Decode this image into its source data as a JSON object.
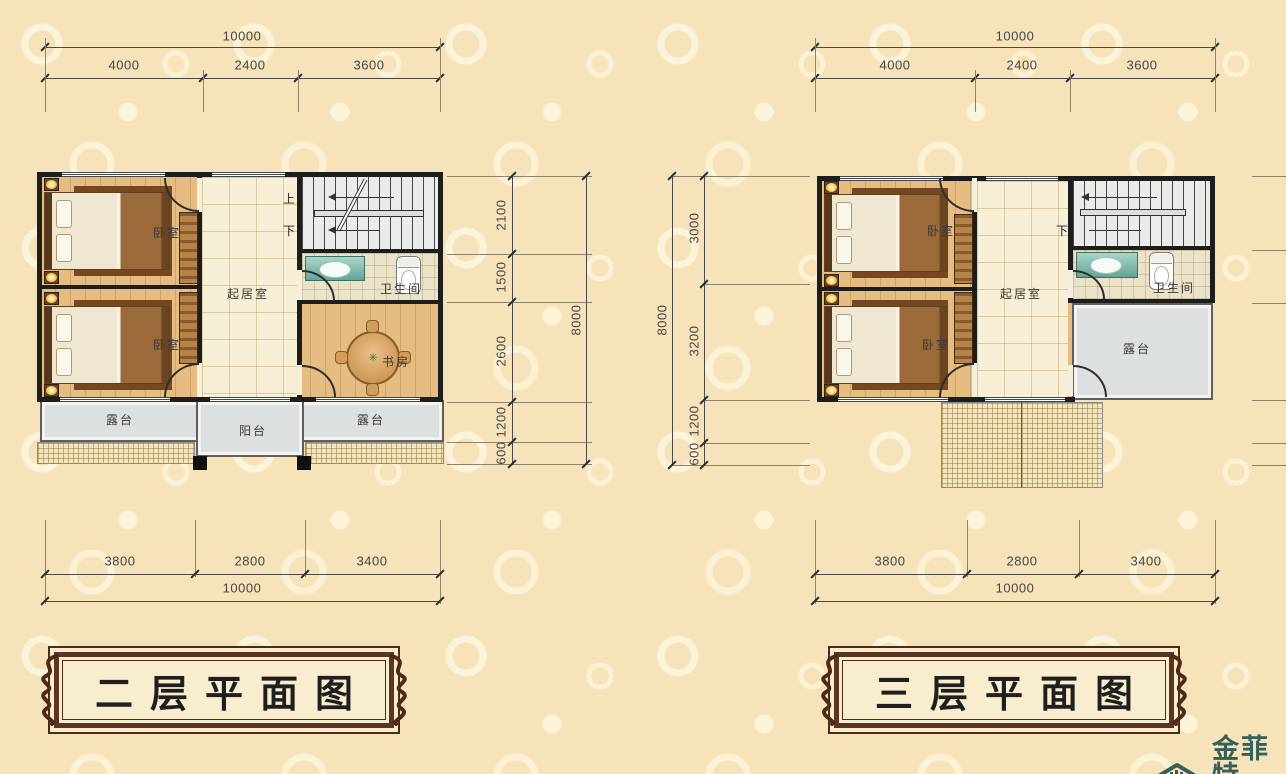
{
  "left_plan": {
    "title": "二层平面图",
    "top": {
      "total": "10000",
      "segments": [
        "4000",
        "2400",
        "3600"
      ]
    },
    "side": {
      "total": "8000",
      "segments": [
        "2100",
        "1500",
        "2600",
        "1200",
        "600"
      ]
    },
    "bottom": {
      "total": "10000",
      "segments": [
        "3800",
        "2800",
        "3400"
      ]
    },
    "rooms": {
      "bedroom_top": "卧室",
      "bedroom_bottom": "卧室",
      "living": "起居室",
      "bathroom": "卫生间",
      "study": "书房",
      "terrace_left": "露台",
      "balcony": "阳台",
      "terrace_right": "露台",
      "stair_up": "上",
      "stair_down": "下"
    }
  },
  "right_plan": {
    "title": "三层平面图",
    "top": {
      "total": "10000",
      "segments": [
        "4000",
        "2400",
        "3600"
      ]
    },
    "side": {
      "total": "8000",
      "segments": [
        "3000",
        "3200",
        "1200",
        "600"
      ]
    },
    "bottom": {
      "total": "10000",
      "segments": [
        "3800",
        "2800",
        "3400"
      ]
    },
    "rooms": {
      "bedroom_top": "卧室",
      "bedroom_bottom": "卧室",
      "living": "起居室",
      "bathroom": "卫生间",
      "terrace": "露台",
      "stair_down": "下"
    }
  },
  "logo": {
    "name": "金菲特",
    "subtext": "JIN FEI TE",
    "icon": "house-roof-icon"
  },
  "colors": {
    "background": "#f7e3ba",
    "wall": "#1d1d1d",
    "wood_floor": "#e5bd82",
    "terrace": "#dce0e1",
    "title_frame": "#4e2a15",
    "logo": "#35605a"
  }
}
